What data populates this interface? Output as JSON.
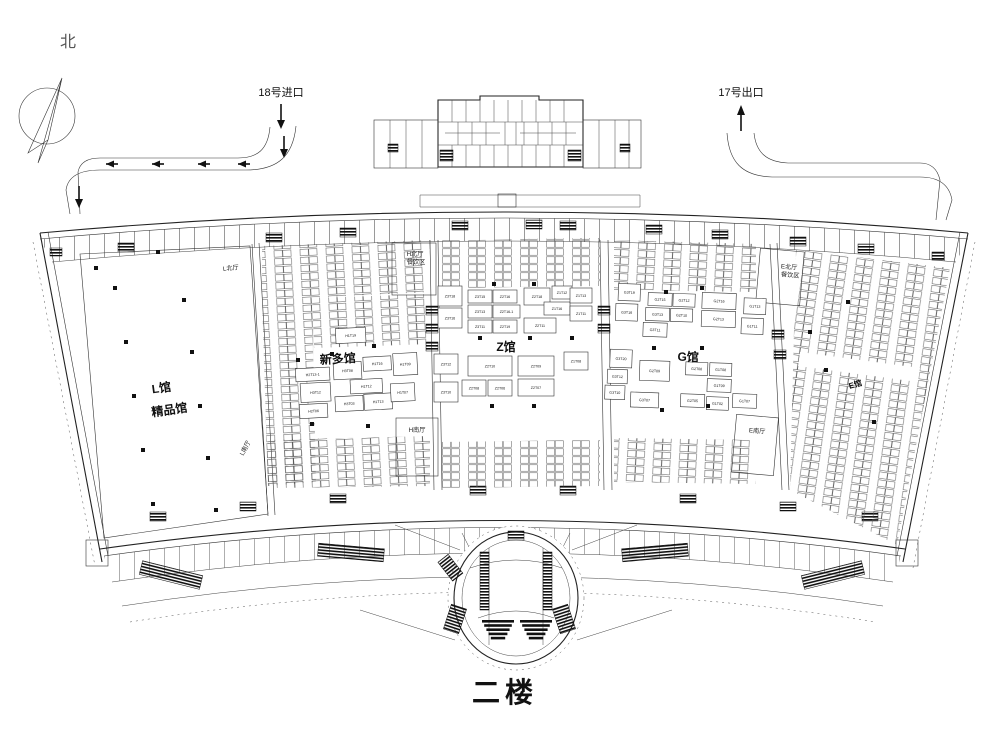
{
  "title": "二楼",
  "compass": {
    "label": "北"
  },
  "ramps": {
    "entrance_label": "18号进口",
    "exit_label": "17号出口"
  },
  "halls": {
    "l": {
      "name": "L馆",
      "subtitle": "精品馆"
    },
    "xinduo": {
      "name": "新多馆"
    },
    "z": {
      "name": "Z馆"
    },
    "g": {
      "name": "G馆"
    },
    "e": {
      "name": "E馆"
    }
  },
  "lobbies": [
    {
      "label": "L北厅",
      "x": 231,
      "y": 270,
      "rot": -6
    },
    {
      "label": "L南厅",
      "x": 247,
      "y": 449,
      "rot": -62
    },
    {
      "label": "H北厅",
      "x": 415,
      "y": 256,
      "rot": 0
    },
    {
      "label": "餐饮区",
      "x": 416,
      "y": 264,
      "rot": 0
    },
    {
      "label": "H南厅",
      "x": 417,
      "y": 432,
      "rot": 0
    },
    {
      "label": "E北厅",
      "x": 789,
      "y": 269,
      "rot": 5
    },
    {
      "label": "餐饮区",
      "x": 790,
      "y": 277,
      "rot": 5
    },
    {
      "label": "E南厅",
      "x": 757,
      "y": 433,
      "rot": 5
    }
  ],
  "booths": {
    "xinduo": [
      {
        "label": "H1T19",
        "x": 338,
        "y": 328,
        "w": 30,
        "h": 15
      },
      {
        "label": "H2T13-1",
        "x": 296,
        "y": 366,
        "w": 34,
        "h": 13
      },
      {
        "label": "H3T08",
        "x": 334,
        "y": 362,
        "w": 28,
        "h": 17
      },
      {
        "label": "H1T16",
        "x": 364,
        "y": 358,
        "w": 28,
        "h": 14
      },
      {
        "label": "H1T09",
        "x": 394,
        "y": 356,
        "w": 24,
        "h": 22
      },
      {
        "label": "H3T12",
        "x": 300,
        "y": 381,
        "w": 30,
        "h": 19
      },
      {
        "label": "H1T12",
        "x": 350,
        "y": 380,
        "w": 32,
        "h": 14
      },
      {
        "label": "H2T06",
        "x": 298,
        "y": 402,
        "w": 28,
        "h": 14
      },
      {
        "label": "H3T03",
        "x": 334,
        "y": 396,
        "w": 28,
        "h": 15
      },
      {
        "label": "H1T13",
        "x": 363,
        "y": 395,
        "w": 28,
        "h": 16
      },
      {
        "label": "H1T07",
        "x": 390,
        "y": 386,
        "w": 24,
        "h": 18
      }
    ],
    "z": [
      {
        "label": "Z3T18",
        "x": 438,
        "y": 286,
        "w": 24,
        "h": 20
      },
      {
        "label": "Z3T16",
        "x": 438,
        "y": 308,
        "w": 24,
        "h": 20
      },
      {
        "label": "Z3T15",
        "x": 468,
        "y": 290,
        "w": 24,
        "h": 13
      },
      {
        "label": "Z2T16",
        "x": 493,
        "y": 290,
        "w": 24,
        "h": 13
      },
      {
        "label": "Z3T13",
        "x": 468,
        "y": 305,
        "w": 24,
        "h": 13
      },
      {
        "label": "Z2T16-1",
        "x": 493,
        "y": 305,
        "w": 27,
        "h": 13
      },
      {
        "label": "Z3T11",
        "x": 468,
        "y": 320,
        "w": 24,
        "h": 13
      },
      {
        "label": "Z2T19",
        "x": 493,
        "y": 320,
        "w": 24,
        "h": 13
      },
      {
        "label": "Z2T18",
        "x": 524,
        "y": 288,
        "w": 26,
        "h": 17
      },
      {
        "label": "Z1T12",
        "x": 552,
        "y": 286,
        "w": 20,
        "h": 13
      },
      {
        "label": "Z1T16",
        "x": 544,
        "y": 302,
        "w": 26,
        "h": 13
      },
      {
        "label": "Z2T11",
        "x": 524,
        "y": 318,
        "w": 32,
        "h": 15
      },
      {
        "label": "Z1T13",
        "x": 570,
        "y": 288,
        "w": 22,
        "h": 15
      },
      {
        "label": "Z1T11",
        "x": 570,
        "y": 306,
        "w": 22,
        "h": 15
      },
      {
        "label": "Z3T12",
        "x": 434,
        "y": 354,
        "w": 24,
        "h": 20
      },
      {
        "label": "Z3T10",
        "x": 434,
        "y": 382,
        "w": 24,
        "h": 20
      },
      {
        "label": "Z2T10",
        "x": 468,
        "y": 356,
        "w": 44,
        "h": 20
      },
      {
        "label": "Z2T08",
        "x": 462,
        "y": 380,
        "w": 24,
        "h": 16
      },
      {
        "label": "Z2T06",
        "x": 488,
        "y": 380,
        "w": 24,
        "h": 16
      },
      {
        "label": "Z2T09",
        "x": 518,
        "y": 356,
        "w": 36,
        "h": 20
      },
      {
        "label": "Z2T07",
        "x": 518,
        "y": 379,
        "w": 36,
        "h": 17
      },
      {
        "label": "Z1T08",
        "x": 564,
        "y": 352,
        "w": 24,
        "h": 18
      }
    ],
    "g": [
      {
        "label": "G3T19",
        "x": 616,
        "y": 286,
        "w": 22,
        "h": 17
      },
      {
        "label": "G3T16",
        "x": 614,
        "y": 306,
        "w": 22,
        "h": 17
      },
      {
        "label": "G2T15",
        "x": 646,
        "y": 294,
        "w": 24,
        "h": 13
      },
      {
        "label": "G2T12",
        "x": 671,
        "y": 294,
        "w": 22,
        "h": 13
      },
      {
        "label": "G3T13",
        "x": 644,
        "y": 309,
        "w": 24,
        "h": 13
      },
      {
        "label": "G2T10",
        "x": 669,
        "y": 309,
        "w": 22,
        "h": 13
      },
      {
        "label": "G3T11",
        "x": 642,
        "y": 324,
        "w": 24,
        "h": 14
      },
      {
        "label": "G2T16",
        "x": 700,
        "y": 292,
        "w": 34,
        "h": 16
      },
      {
        "label": "G2T13",
        "x": 700,
        "y": 310,
        "w": 34,
        "h": 16
      },
      {
        "label": "G1T13",
        "x": 742,
        "y": 296,
        "w": 22,
        "h": 16
      },
      {
        "label": "G1T11",
        "x": 740,
        "y": 316,
        "w": 22,
        "h": 16
      },
      {
        "label": "G3T20",
        "x": 610,
        "y": 352,
        "w": 22,
        "h": 18
      },
      {
        "label": "G3T12",
        "x": 608,
        "y": 372,
        "w": 20,
        "h": 14
      },
      {
        "label": "G3T10",
        "x": 606,
        "y": 388,
        "w": 20,
        "h": 14
      },
      {
        "label": "G2T09",
        "x": 640,
        "y": 362,
        "w": 30,
        "h": 20
      },
      {
        "label": "G3T07",
        "x": 632,
        "y": 394,
        "w": 28,
        "h": 15
      },
      {
        "label": "G2T08",
        "x": 686,
        "y": 362,
        "w": 22,
        "h": 13
      },
      {
        "label": "G1T08",
        "x": 710,
        "y": 362,
        "w": 22,
        "h": 13
      },
      {
        "label": "G1T09",
        "x": 708,
        "y": 378,
        "w": 24,
        "h": 13
      },
      {
        "label": "G2T05",
        "x": 682,
        "y": 394,
        "w": 24,
        "h": 13
      },
      {
        "label": "G1T02",
        "x": 708,
        "y": 396,
        "w": 22,
        "h": 13
      },
      {
        "label": "G1T07",
        "x": 734,
        "y": 392,
        "w": 24,
        "h": 14
      }
    ]
  },
  "l_hall_columns": [
    [
      96,
      268
    ],
    [
      115,
      288
    ],
    [
      126,
      342
    ],
    [
      134,
      396
    ],
    [
      143,
      450
    ],
    [
      153,
      504
    ],
    [
      184,
      300
    ],
    [
      192,
      352
    ],
    [
      200,
      406
    ],
    [
      208,
      458
    ],
    [
      216,
      510
    ],
    [
      158,
      252
    ]
  ]
}
